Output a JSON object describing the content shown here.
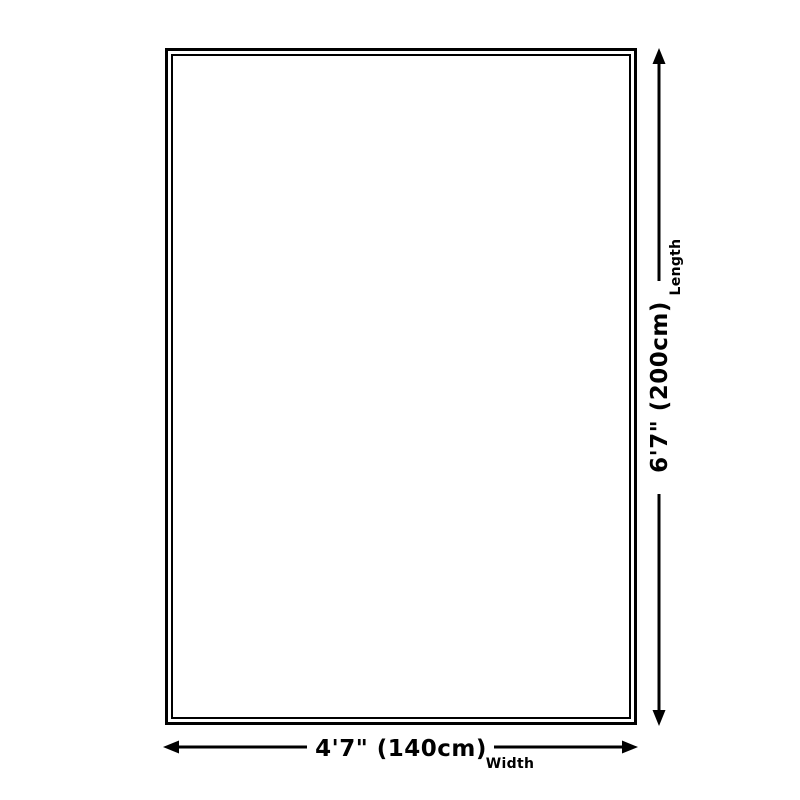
{
  "page": {
    "background": "#ffffff"
  },
  "diagram": {
    "kind": "product-size-diagram",
    "line_color": "#000000",
    "length": {
      "value": "6'7\" (200cm)",
      "label": "Length"
    },
    "width": {
      "value": "4'7\" (140cm)",
      "label": "Width"
    }
  }
}
